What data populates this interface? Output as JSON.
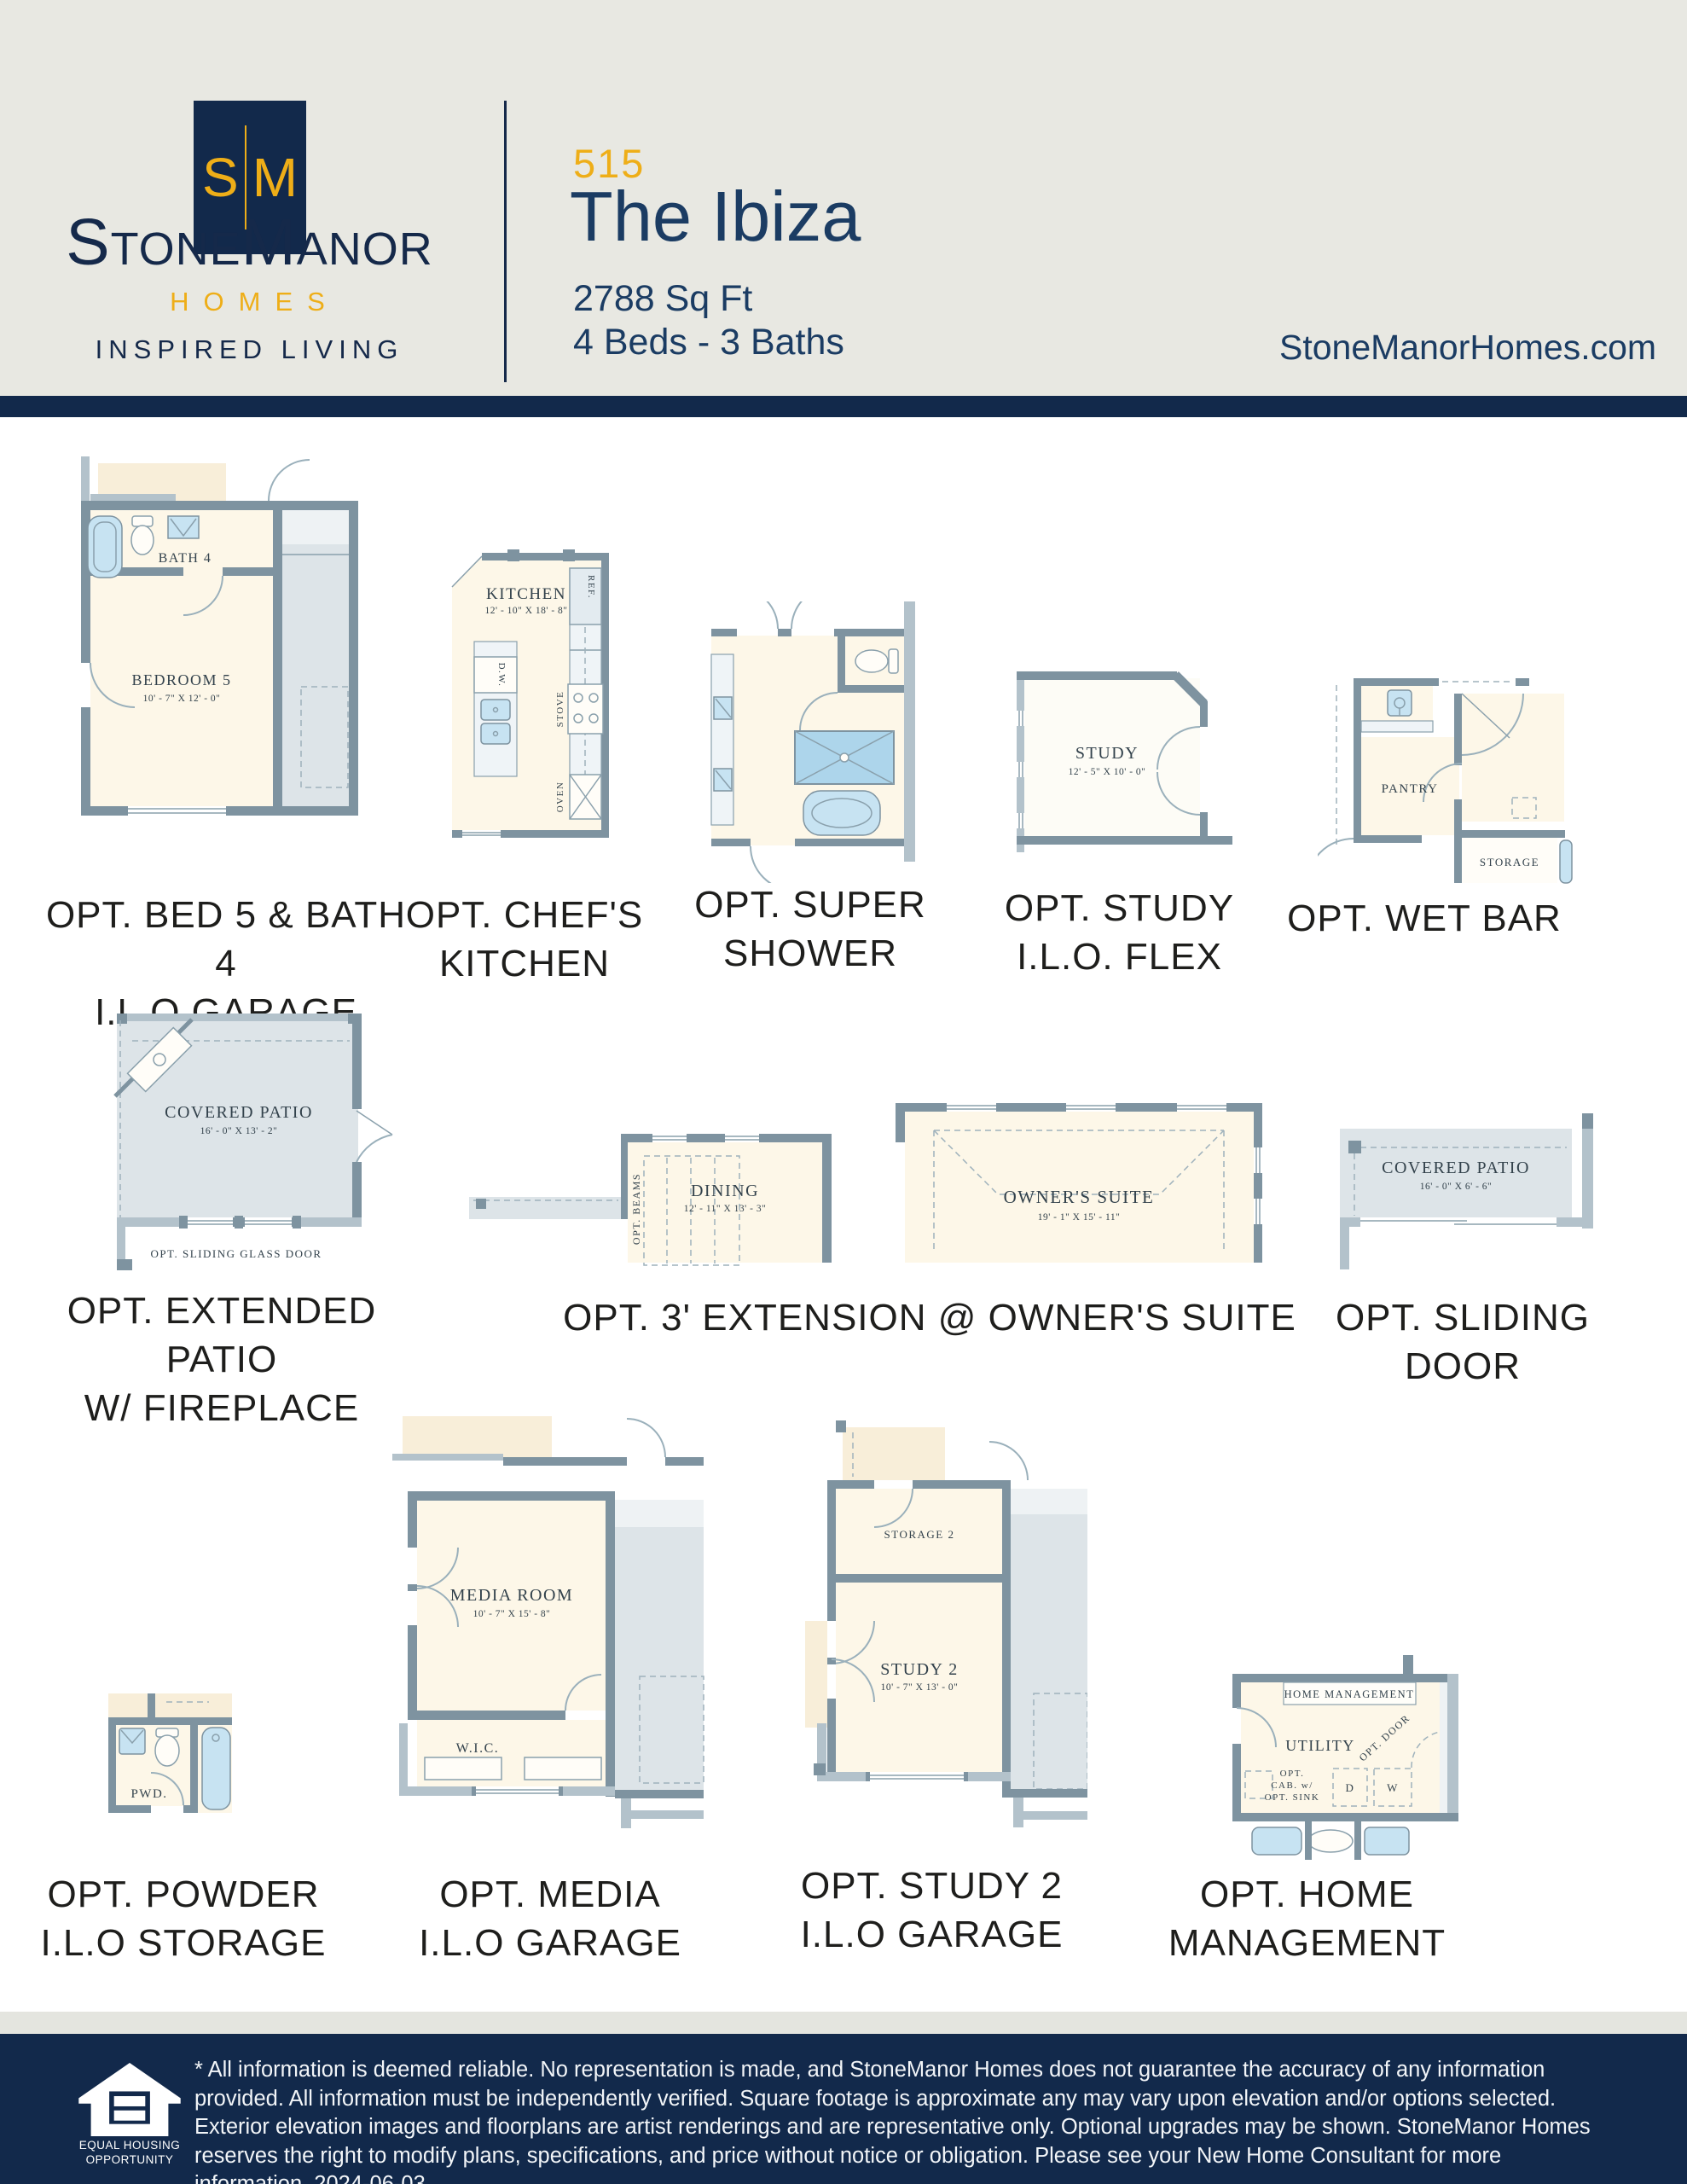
{
  "colors": {
    "navy": "#12294b",
    "gold": "#eeae18",
    "title_navy": "#1b3c63",
    "wall_gray": "#7e93a0",
    "cream": "#fdf7e8",
    "patio_gray": "#dde4e8"
  },
  "header": {
    "logo_letter_s": "S",
    "logo_letter_m": "M",
    "brand_name": "StoneManor",
    "brand_sub": "HOMES",
    "brand_tagline": "INSPIRED LIVING",
    "plan_number": "515",
    "plan_name": "The Ibiza",
    "sqft": "2788 Sq Ft",
    "beds_baths": "4 Beds - 3 Baths",
    "website": "StoneManorHomes.com"
  },
  "plans": {
    "bed5": {
      "caption1": "OPT. BED 5 & BATH 4",
      "caption2": "I.L.O GARAGE",
      "bath_label": "BATH 4",
      "bedroom_label": "BEDROOM 5",
      "bedroom_dim": "10' - 7\" X 12' - 0\""
    },
    "kitchen": {
      "caption1": "OPT. CHEF'S",
      "caption2": "KITCHEN",
      "room_label": "KITCHEN",
      "room_dim": "12' - 10\" X 18' - 8\"",
      "ref_label": "REF.",
      "dw_label": "D.W.",
      "stove_label": "STOVE",
      "oven_label": "OVEN"
    },
    "shower": {
      "caption1": "OPT. SUPER",
      "caption2": "SHOWER"
    },
    "study": {
      "caption1": "OPT. STUDY",
      "caption2": "I.L.O. FLEX",
      "room_label": "STUDY",
      "room_dim": "12' - 5\" X 10' - 0\""
    },
    "wetbar": {
      "caption": "OPT. WET BAR",
      "pantry_label": "PANTRY",
      "storage_label": "STORAGE"
    },
    "patio": {
      "caption1": "OPT. EXTENDED PATIO",
      "caption2": "W/ FIREPLACE",
      "room_label": "COVERED PATIO",
      "room_dim": "16' - 0\" X 13' - 2\"",
      "door_label": "OPT. SLIDING GLASS DOOR"
    },
    "extension": {
      "caption": "OPT. 3' EXTENSION @ OWNER'S SUITE",
      "dining_label": "DINING",
      "dining_dim": "12' - 11\" X 13' - 3\"",
      "beams_label": "OPT. BEAMS",
      "suite_label": "OWNER'S SUITE",
      "suite_dim": "19' - 1\" X 15' - 11\""
    },
    "sliding": {
      "caption": "OPT. SLIDING DOOR",
      "room_label": "COVERED PATIO",
      "room_dim": "16' - 0\" X 6' - 6\""
    },
    "powder": {
      "caption1": "OPT. POWDER",
      "caption2": "I.L.O STORAGE",
      "room_label": "PWD."
    },
    "media": {
      "caption1": "OPT. MEDIA",
      "caption2": "I.L.O GARAGE",
      "room_label": "MEDIA ROOM",
      "room_dim": "10' - 7\" X 15' - 8\"",
      "wic_label": "W.I.C."
    },
    "study2": {
      "caption1": "OPT. STUDY 2",
      "caption2": "I.L.O GARAGE",
      "storage_label": "STORAGE 2",
      "room_label": "STUDY 2",
      "room_dim": "10' - 7\" X 13' - 0\""
    },
    "homemgmt": {
      "caption1": "OPT. HOME",
      "caption2": "MANAGEMENT",
      "banner_label": "HOME MANAGEMENT",
      "utility_label": "UTILITY",
      "door_label": "OPT. DOOR",
      "cab1": "OPT.",
      "cab2": "CAB. w/",
      "cab3": "OPT. SINK",
      "d_label": "D",
      "w_label": "W"
    }
  },
  "footer": {
    "eho_line1": "EQUAL HOUSING",
    "eho_line2": "OPPORTUNITY",
    "disclaimer": "* All information is deemed reliable. No representation is made, and StoneManor Homes does not guarantee the accuracy of any information provided. All information must be independently verified. Square footage is approximate any may vary upon elevation and/or options selected. Exterior elevation images and floorplans are artist renderings and are representative only. Optional upgrades may be shown. StoneManor Homes reserves the right to modify plans, specifications, and price without notice or obligation. Please see your New Home Consultant for more information. 2024-06-03"
  }
}
